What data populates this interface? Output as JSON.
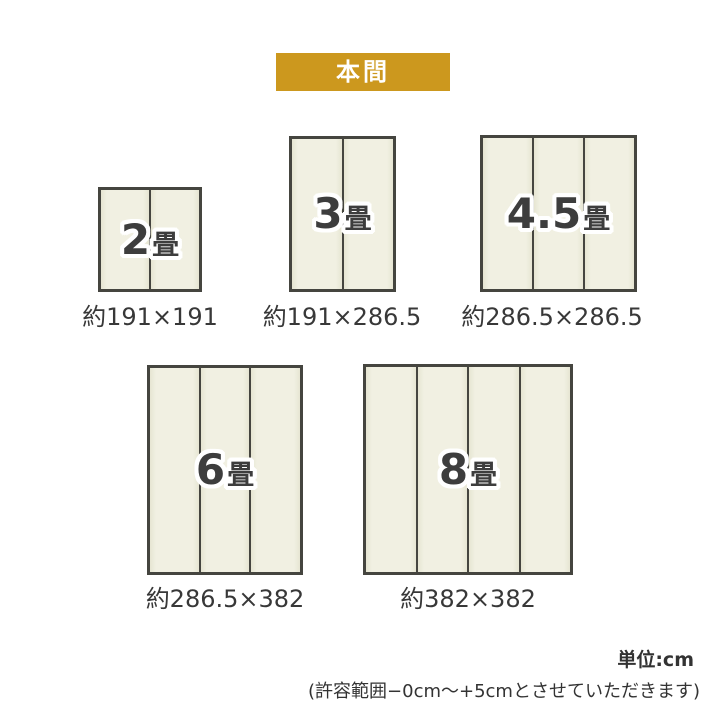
{
  "banner": {
    "label": "本間"
  },
  "mats": [
    {
      "number": "2",
      "suffix": "畳",
      "dimensions": "約191×191",
      "panels": 2
    },
    {
      "number": "3",
      "suffix": "畳",
      "dimensions": "約191×286.5",
      "panels": 2
    },
    {
      "number": "4.5",
      "suffix": "畳",
      "dimensions": "約286.5×286.5",
      "panels": 3
    },
    {
      "number": "6",
      "suffix": "畳",
      "dimensions": "約286.5×382",
      "panels": 3
    },
    {
      "number": "8",
      "suffix": "畳",
      "dimensions": "約382×382",
      "panels": 4
    }
  ],
  "notes": {
    "unit": "単位:cm",
    "tolerance": "(許容範囲−0cm〜+5cmとさせていただきます)"
  },
  "colors": {
    "banner_bg": "#CC981E",
    "banner_text": "#FFFFFF",
    "mat_fill": "#F0EFE1",
    "mat_fill_edge": "#E6E5D2",
    "mat_border": "#45453F",
    "size_label_text": "#3D3D3D",
    "dimension_text": "#383838"
  }
}
